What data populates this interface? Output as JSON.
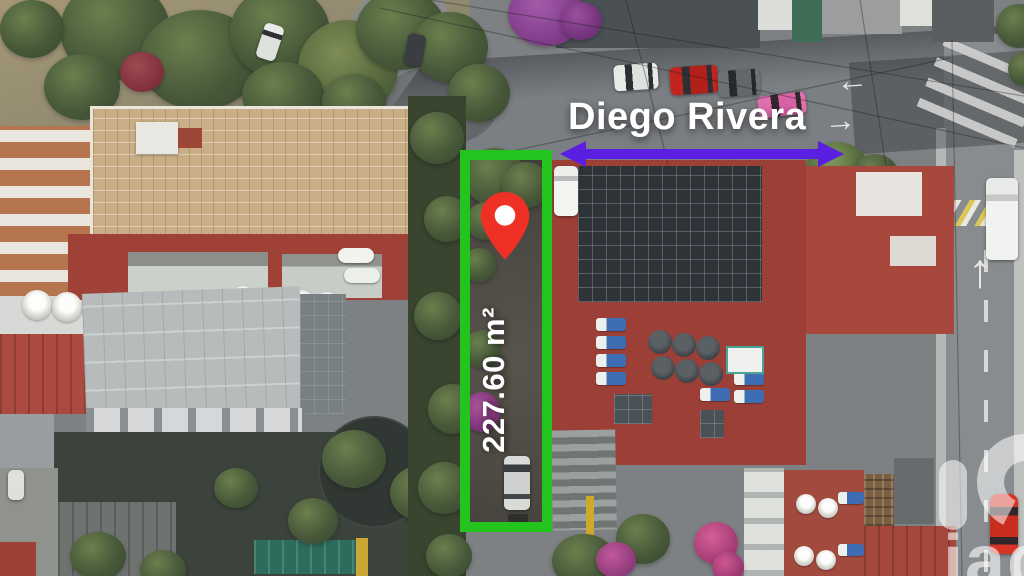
{
  "overlays": {
    "street_label": "Diego Rivera",
    "area_label": "227.60 m²",
    "watermark_text": "iad"
  },
  "colors": {
    "lot_outline": "#23c41d",
    "street_arrow": "#5a1fe0",
    "location_pin": "#ee3124",
    "label_text": "#ffffff"
  }
}
